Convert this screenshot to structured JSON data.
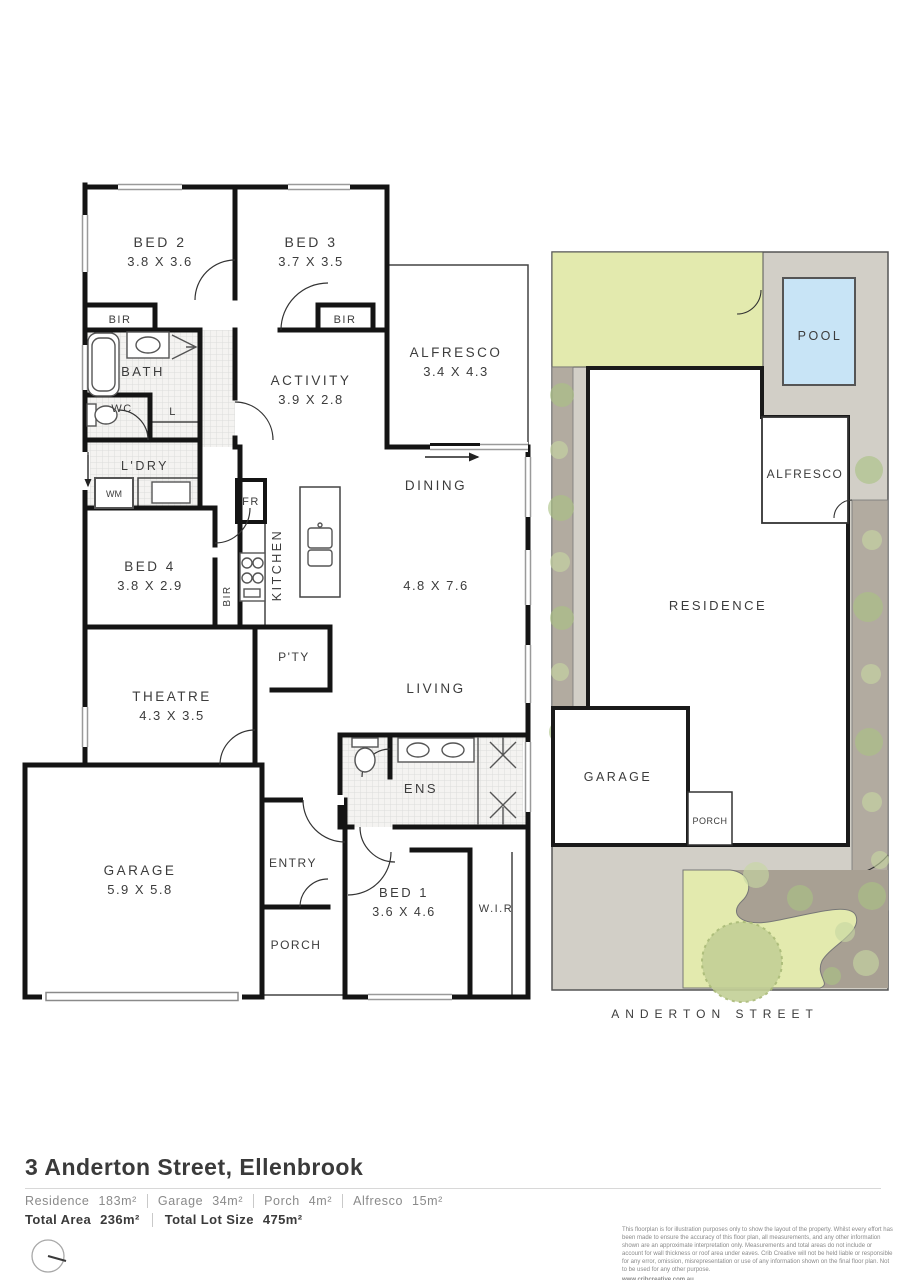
{
  "floor_plan": {
    "rooms": {
      "bed2": {
        "name": "BED 2",
        "dims": "3.8 X 3.6"
      },
      "bed3": {
        "name": "BED 3",
        "dims": "3.7 X 3.5"
      },
      "alfresco": {
        "name": "ALFRESCO",
        "dims": "3.4 X 4.3"
      },
      "activity": {
        "name": "ACTIVITY",
        "dims": "3.9 X 2.8"
      },
      "bath": {
        "name": "BATH"
      },
      "wc": {
        "name": "WC"
      },
      "linen": {
        "name": "L"
      },
      "bir_bed2": {
        "name": "BIR"
      },
      "bir_bed3": {
        "name": "BIR"
      },
      "bir_bed4": {
        "name": "BIR"
      },
      "laundry": {
        "name": "L'DRY"
      },
      "wm": {
        "name": "WM"
      },
      "fridge": {
        "name": "FR"
      },
      "kitchen": {
        "name": "KITCHEN"
      },
      "bed4": {
        "name": "BED 4",
        "dims": "3.8 X 2.9"
      },
      "dining": {
        "name": "DINING"
      },
      "living": {
        "name": "LIVING"
      },
      "living_dims": "4.8 X 7.6",
      "pantry": {
        "name": "P'TY"
      },
      "theatre": {
        "name": "THEATRE",
        "dims": "4.3 X 3.5"
      },
      "ens": {
        "name": "ENS"
      },
      "garage": {
        "name": "GARAGE",
        "dims": "5.9 X 5.8"
      },
      "entry": {
        "name": "ENTRY"
      },
      "porch": {
        "name": "PORCH"
      },
      "bed1": {
        "name": "BED 1",
        "dims": "3.6 X 4.6"
      },
      "wir": {
        "name": "W.I.R"
      }
    }
  },
  "site_plan": {
    "labels": {
      "pool": "POOL",
      "alfresco": "ALFRESCO",
      "residence": "RESIDENCE",
      "garage": "GARAGE",
      "porch": "PORCH"
    },
    "street": "ANDERTON STREET",
    "colors": {
      "lawn": "#e3eaae",
      "paving": "#d2cfc7",
      "side_strip": "#b2aba0",
      "garden": "#a8a093",
      "pool": "#c8e4f6",
      "big_tree": "#c3d096"
    }
  },
  "footer": {
    "title": "3 Anderton Street, Ellenbrook",
    "areas": [
      {
        "label": "Residence",
        "value": "183m²"
      },
      {
        "label": "Garage",
        "value": "34m²"
      },
      {
        "label": "Porch",
        "value": "4m²"
      },
      {
        "label": "Alfresco",
        "value": "15m²"
      }
    ],
    "totals": [
      {
        "label": "Total Area",
        "value": "236m²"
      },
      {
        "label": "Total Lot Size",
        "value": "475m²"
      }
    ],
    "disclaimer": "This floorplan is for illustration purposes only to show the layout of the property. Whilst every effort has been made to ensure the accuracy of this floor plan, all measurements, and any other information shown are an approximate interpretation only. Measurements and total areas do not include or account for wall thickness or roof area under eaves. Crib Creative will not be held liable or responsible for any error, omission, misrepresentation or use of any information shown on the final floor plan. Not to be used for any other purpose.",
    "website": "www.cribcreative.com.au"
  }
}
